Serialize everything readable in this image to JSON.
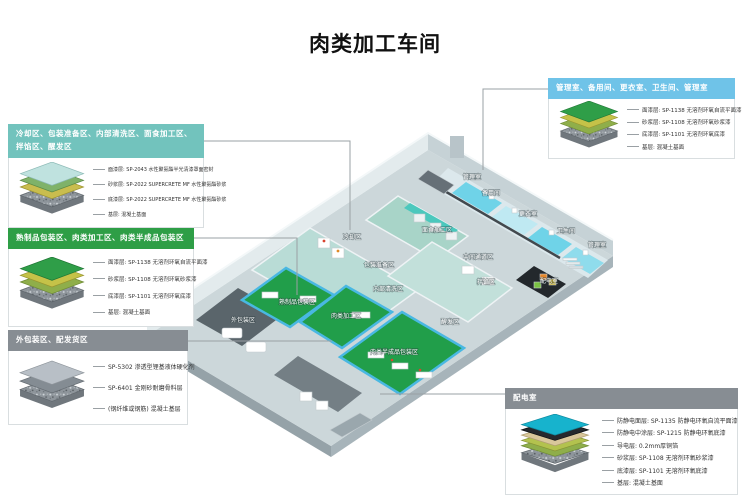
{
  "title": "肉类加工车间",
  "colors": {
    "callout_teal": "#72c3bd",
    "callout_green": "#2e9e46",
    "callout_gray": "#878d93",
    "callout_blue": "#6fc3e8",
    "floor_green": "#219e4a",
    "floor_mint": "#b9dcd6",
    "floor_cyan": "#6fd3e8",
    "antistatic_cyan": "#17b3cd",
    "power_room_black": "#23282c"
  },
  "callouts": [
    {
      "header": "冷却区、包装准备区、内部清洗区、面食加工区、拌馅区、醒发区",
      "lines": [
        "面漆层: SP-2043 水性聚氨酯半光清漆罩面密封",
        "砂浆层: SP-2022 SUPERCRETE MF 水性聚氨酯砂浆",
        "底漆层: SP-2022 SUPERCRETE MF 水性聚氨酯砂浆",
        "基层: 混凝土基面"
      ]
    },
    {
      "header": "熟制品包装区、肉类加工区、肉类半成品包装区",
      "lines": [
        "面漆层: SP-1138 无溶剂环氧自流平面漆",
        "砂浆层: SP-1108 无溶剂环氧砂浆漆",
        "底漆层: SP-1101 无溶剂环氧底漆",
        "基层: 混凝土基面"
      ]
    },
    {
      "header": "外包装区、配发货区",
      "lines": [
        "SP-5302 渗透型锂基液体硬化剂",
        "SP-6401 金刚砂耐磨骨料层",
        "(钢纤维或钢筋) 混凝土基层"
      ]
    },
    {
      "header": "管理室、备用间、更衣室、卫生间、管理室",
      "lines": [
        "面漆层: SP-1138 无溶剂环氧自流平面漆",
        "砂浆层: SP-1108 无溶剂环氧砂浆漆",
        "底漆层: SP-1101 无溶剂环氧底漆",
        "基层: 混凝土基面"
      ]
    },
    {
      "header": "配电室",
      "lines": [
        "防静电面层: SP-1135 防静电环氧自流平面漆",
        "防静电中涂层: SP-1215 防静电环氧底漆",
        "导电层: 0.2mm厚铜箔",
        "砂浆层: SP-1108 无溶剂环氧砂浆漆",
        "底漆层: SP-1101 无溶剂环氧底漆",
        "基层: 混凝土基面"
      ]
    }
  ],
  "rooms": [
    {
      "label": "冷却区"
    },
    {
      "label": "包装准备区"
    },
    {
      "label": "内部清洗区"
    },
    {
      "label": "面食加工区"
    },
    {
      "label": "管理室"
    },
    {
      "label": "备用间"
    },
    {
      "label": "更衣室"
    },
    {
      "label": "卫生间"
    },
    {
      "label": "管理室"
    },
    {
      "label": "中间通道区"
    },
    {
      "label": "拌馅区"
    },
    {
      "label": "醒发区"
    },
    {
      "label": "配电室"
    },
    {
      "label": "熟制品包装区"
    },
    {
      "label": "肉类加工区"
    },
    {
      "label": "肉类半成品包装区"
    },
    {
      "label": "外包装区"
    }
  ]
}
